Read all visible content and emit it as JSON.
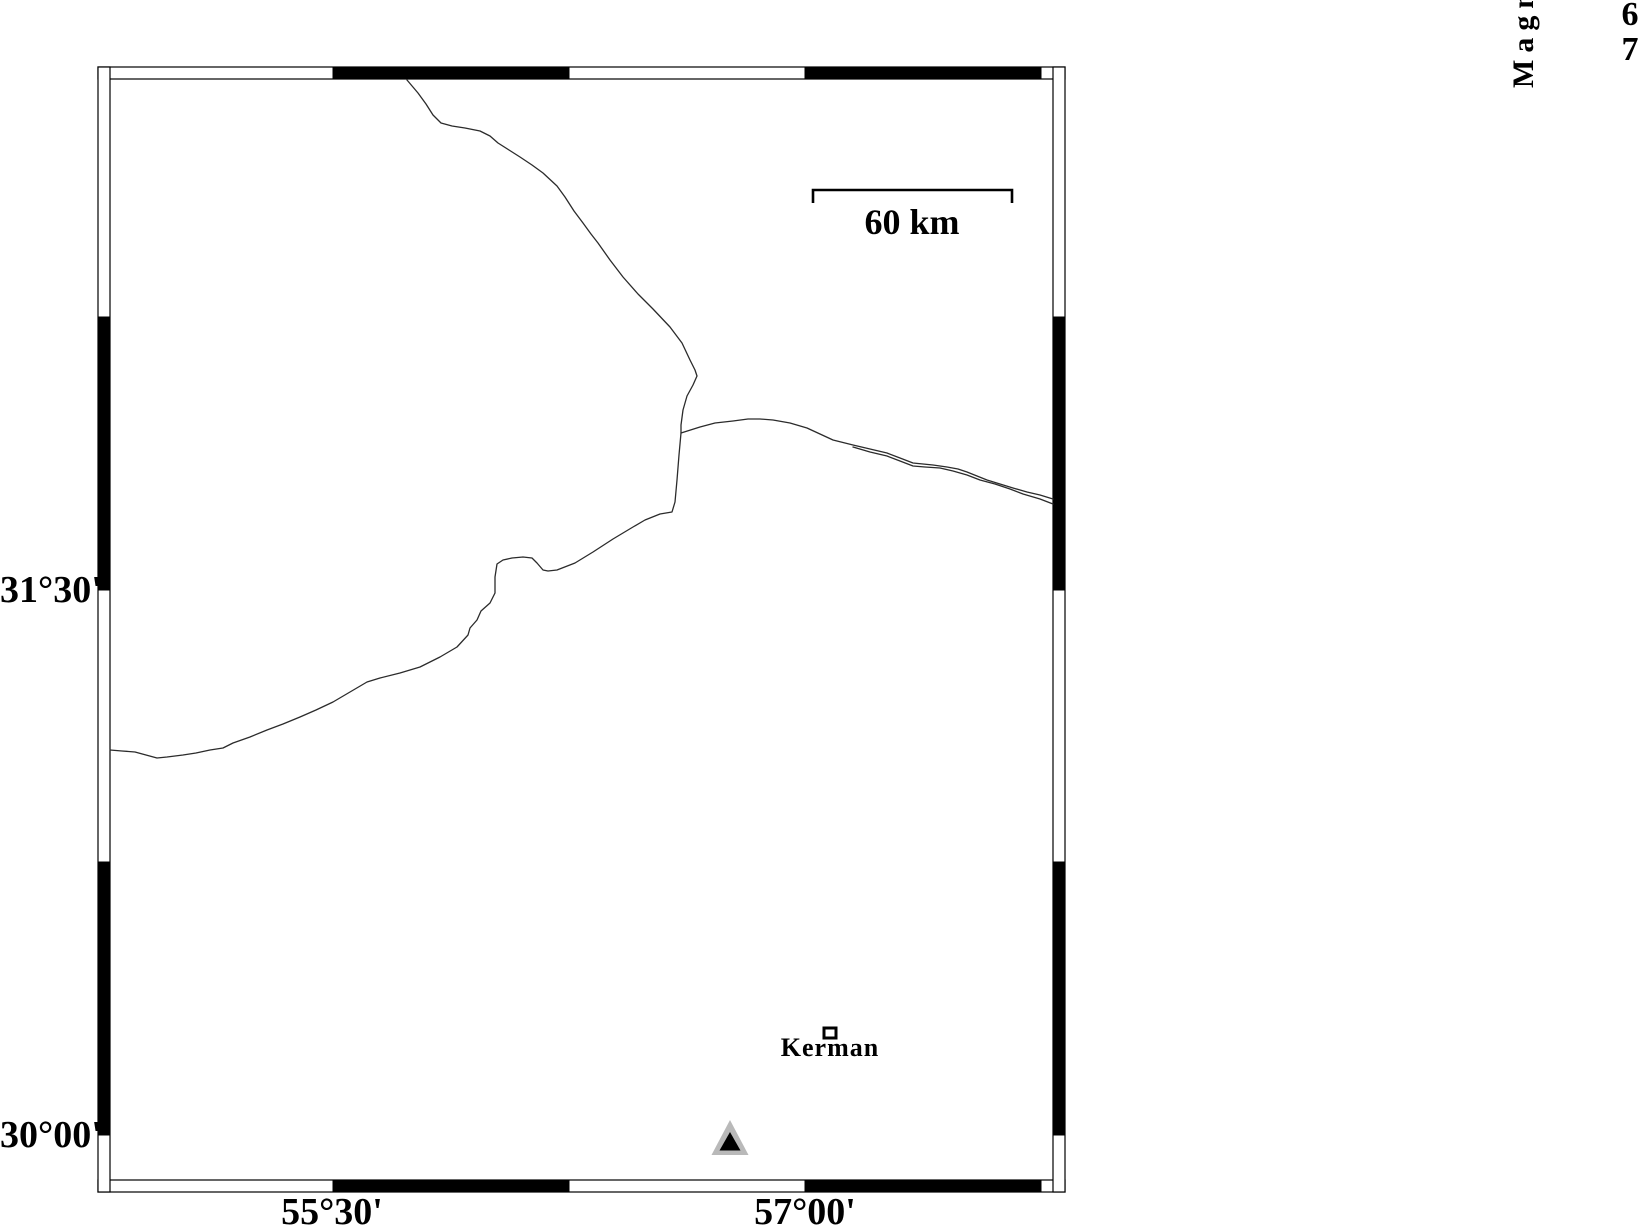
{
  "map": {
    "grid": {
      "lat": [
        {
          "label": "31°30'"
        },
        {
          "label": "30°00'"
        }
      ],
      "lon": [
        {
          "label": "55°30'"
        },
        {
          "label": "57°00'"
        }
      ]
    },
    "scale_bar": {
      "label": "60 km"
    },
    "city": {
      "name": "Kerman"
    },
    "roads": [
      {
        "d": "M407,80 L418,93 L426,104 L433,115 L441,123 L452,126 L465,128 L480,131 L490,136 L498,143 L509,150 L520,157 L532,165 L543,173 L557,186 L565,197 L574,211 L583,223 L591,234 L598,243 L610,260 L623,277 L638,294 L653,309 L670,327 L682,343 L690,360 L695,370 L697,376 L693,385 L687,396 L683,410 L681,425 L681,433 L679,455 L677,480 L675,502 L672,512 L660,514 L645,520 L633,527 L613,539 L593,552 L575,563 L557,570 L548,571 L543,570 L537,563 L532,558 L523,557 L512,558 L503,560 L497,564 L495,577 L495,593 L490,603 L481,611 L477,620 L470,628 L468,635 L457,647 L440,657 L420,667 L400,673 L380,678 L367,682 L350,692 L333,702 L316,710 L300,717 L283,724 L267,730 L250,737 L233,743 L223,748 L210,750 L196,753 L183,755 L167,757 L157,758 L146,755 L135,752 L122,751 L110,750"
      },
      {
        "d": "M681,433 L700,427 L715,423 L733,421 L748,419 L760,419 L773,420 L790,423 L807,428 L820,434 L833,440 L853,445 L870,449 L887,453 L900,458 L913,463 L923,464 L933,465 L947,467 L958,469 L967,472 L977,476 L987,480 L1000,484 L1013,488 L1027,492 L1040,495 L1053,499"
      },
      {
        "d": "M853,447 L870,452 L887,456 L900,461 L913,466 L925,467 L940,468 L953,471 L967,475 L980,480 L995,484 L1010,489 L1023,494 L1040,499 L1053,504"
      }
    ]
  },
  "legend": {
    "title": "Magnitude",
    "magnitudes": [
      "6",
      "7"
    ]
  },
  "colors": {
    "ink": "#000000",
    "road": "#2b2b2b",
    "triangle_fill": "#b9b9b9",
    "triangle_inner": "#000000"
  }
}
